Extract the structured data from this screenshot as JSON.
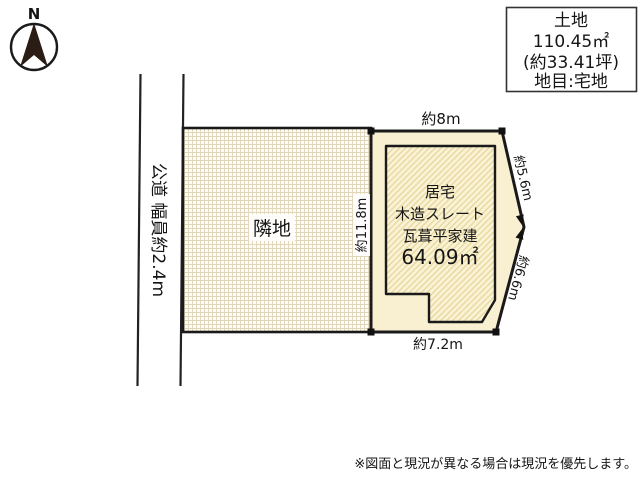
{
  "compass": {
    "north_label": "N"
  },
  "info_box": {
    "title": "土地",
    "area_sqm": "110.45㎡",
    "area_tsubo": "(約33.41坪)",
    "land_category": "地目:宅地"
  },
  "road": {
    "label": "公道 幅員約2.4m"
  },
  "neighbor": {
    "label": "隣地"
  },
  "dimensions": {
    "top": "約8m",
    "right_upper": "約5.6m",
    "right_lower": "約6.6m",
    "bottom": "約7.2m",
    "left": "約11.8m"
  },
  "building": {
    "type": "居宅",
    "structure_line1": "木造スレート",
    "structure_line2": "瓦葺平家建",
    "area": "64.09㎡"
  },
  "footer": {
    "note": "※図面と現況が異なる場合は現況を優先します。"
  },
  "colors": {
    "line": "#1a1a1a",
    "plot_fill": "#f8f0d0",
    "building_base": "#faf3d6",
    "building_stripe": "#e9d9a2",
    "neighbor_base": "#fffdf6",
    "neighbor_grid": "#e2d6b8",
    "needle": "#2b1d16",
    "background": "#ffffff"
  }
}
